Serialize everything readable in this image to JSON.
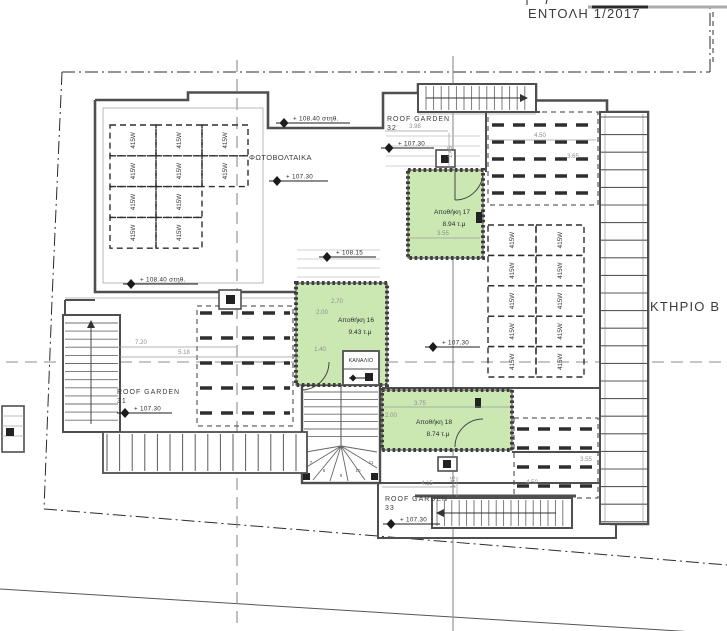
{
  "title": "ΕΝΤΟΛΗ 1/2017",
  "building_label": "ΚΤΗΡΙΟ Β",
  "photovoltaics_label": "ΦΩΤΟΒΟΛΤΑΙΚΑ",
  "channel_label": "ΚΑΝΑΛΙΟ",
  "roof_gardens": [
    {
      "name": "ROOF GARDEN",
      "number": "32"
    },
    {
      "name": "ROOF GARDEN",
      "number": "31"
    },
    {
      "name": "ROOF GARDEN",
      "number": "33"
    }
  ],
  "storage_rooms": [
    {
      "name": "Αποθήκη 17",
      "area": "8.94 τ.μ"
    },
    {
      "name": "Αποθήκη 16",
      "area": "9.43 τ.μ"
    },
    {
      "name": "Αποθήκη 18",
      "area": "8.74 τ.μ"
    }
  ],
  "solar_panels": {
    "label": "415W",
    "left_grid_count": 10,
    "right_grid_count": 10
  },
  "elevation_markers": [
    {
      "label": "+ 108.40 στηθ."
    },
    {
      "label": "+ 107.30"
    },
    {
      "label": "+ 107.30"
    },
    {
      "label": "+ 108.15"
    },
    {
      "label": "+ 108.40 στηθ."
    },
    {
      "label": "+ 107.30"
    },
    {
      "label": "+ 107.30"
    },
    {
      "label": "+ 107.30"
    }
  ],
  "dimensions": {
    "top_left_width": "3.98",
    "top_left_height": "1.45",
    "top_right_width": "4.50",
    "top_right_height": "3.65",
    "room17_width": "3.55",
    "room16_width": "2.70",
    "room16_height": "2.00",
    "room16_inner": "1.40",
    "rg31_width": "7.20",
    "rg31_span": "5.18",
    "room18_width": "3.75",
    "room18_height": "2.00",
    "bottom_left_width": "4.15",
    "bottom_height": "1.45",
    "bottom_right_width": "4.50",
    "bottom_right_height": "3.55"
  },
  "stair_step_numbers": [
    "7",
    "8",
    "9",
    "10",
    "11"
  ],
  "colors": {
    "room_fill": "#cbe8b2",
    "wall": "#4f4f4f",
    "dim_text": "#8e8e8e"
  }
}
